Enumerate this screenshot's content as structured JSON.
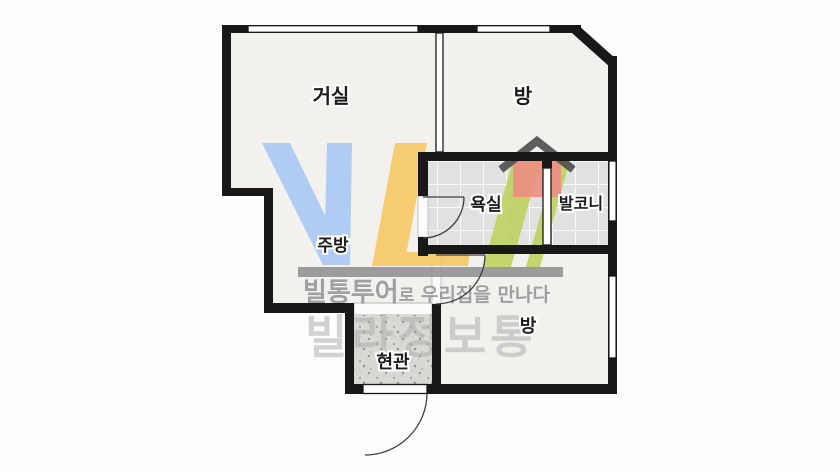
{
  "floorplan": {
    "rooms": [
      {
        "id": "living",
        "label": "거실"
      },
      {
        "id": "room-top",
        "label": "방"
      },
      {
        "id": "bathroom",
        "label": "욕실"
      },
      {
        "id": "balcony",
        "label": "발코니"
      },
      {
        "id": "kitchen",
        "label": "주방"
      },
      {
        "id": "room-bottom",
        "label": "방"
      },
      {
        "id": "entrance",
        "label": "현관"
      }
    ]
  },
  "watermark": {
    "logo_letters": "VL",
    "tagline_brand": "빌통투어",
    "tagline_particle": "로",
    "tagline_rest": " 우리집을 만나다",
    "big_text": "빌라정보통",
    "colors": {
      "blue": "#a9c7f4",
      "yellow": "#f6c761",
      "green": "#bcd25d",
      "house": "#ec8e84",
      "roof": "#4e4e4e",
      "bar": "#8d8d8d",
      "tagline": "#8f8f92",
      "big": "#a9a9a9"
    }
  },
  "colors": {
    "wall": "#181818",
    "floor": "#f2f1ee",
    "tile": "#e1e1df",
    "tile_grout": "#fafaf9",
    "entrance_floor": "#d9d8d4",
    "exterior": "#fdfdfc",
    "label_text": "#1c1c1c"
  }
}
